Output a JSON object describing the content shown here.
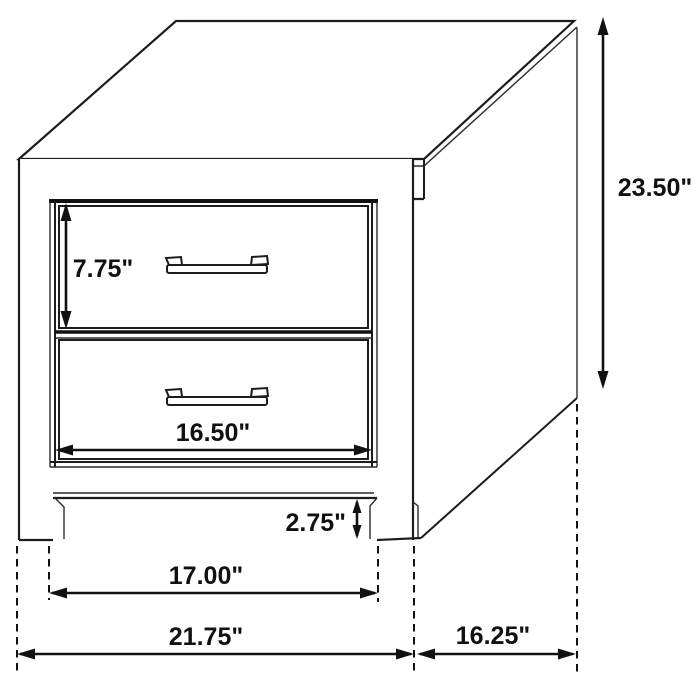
{
  "diagram": {
    "labels": {
      "overall_height": "23.50\"",
      "top_drawer_height": "7.75\"",
      "drawer_width": "16.50\"",
      "base_clearance": "2.75\"",
      "inner_leg_span": "17.00\"",
      "overall_width": "21.75\"",
      "side_depth": "16.25\""
    }
  }
}
